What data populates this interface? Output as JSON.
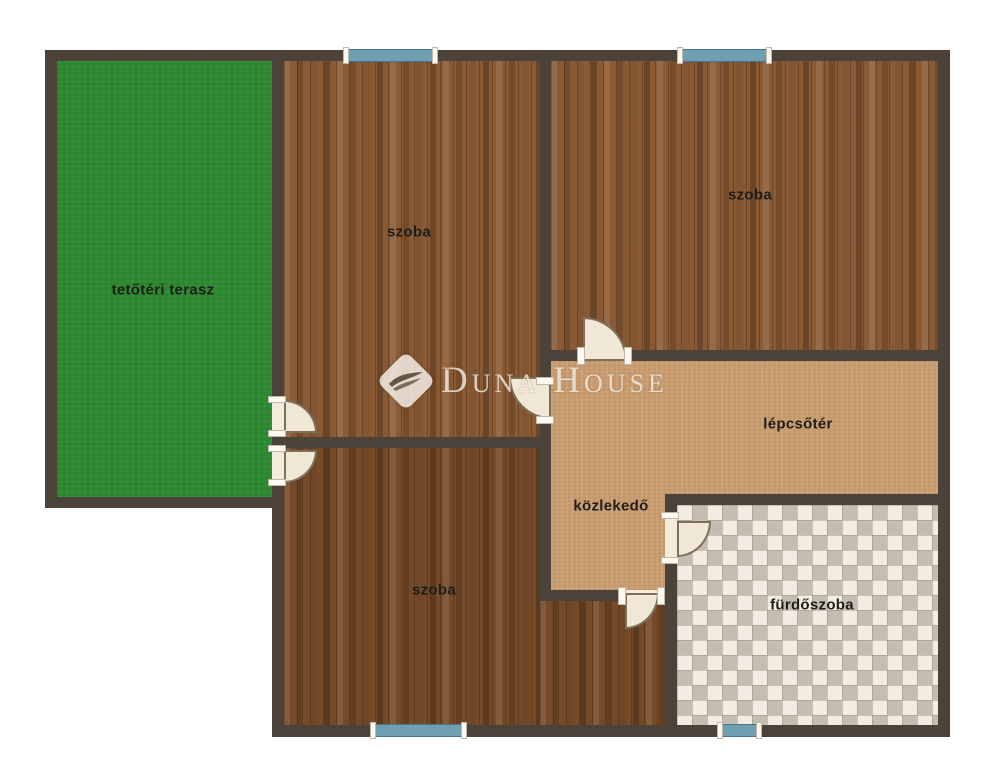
{
  "plan": {
    "brand": {
      "logo_text": "Duna House",
      "registered": "®"
    },
    "rooms": {
      "terrace": {
        "label": "tetőtéri terasz"
      },
      "bedroom_top_left": {
        "label": "szoba"
      },
      "bedroom_top_right": {
        "label": "szoba"
      },
      "bedroom_bottom": {
        "label": "szoba"
      },
      "stairwell": {
        "label": "lépcsőtér"
      },
      "hallway": {
        "label": "közlekedő"
      },
      "bathroom": {
        "label": "fürdőszoba"
      }
    },
    "theme": {
      "wall": "#4b4339",
      "terrace_green": "#2e8a31",
      "wood_light": "#8a5a35",
      "wood_dark": "#754a29",
      "tan": "#c89b6e",
      "tile_base": "#f2ece2",
      "tile_gray": "#aba294",
      "window_blue": "#6fa0b2",
      "door_leaf": "#f0e7d4",
      "label_text": "#1f1d1a",
      "background": "#ffffff"
    }
  }
}
